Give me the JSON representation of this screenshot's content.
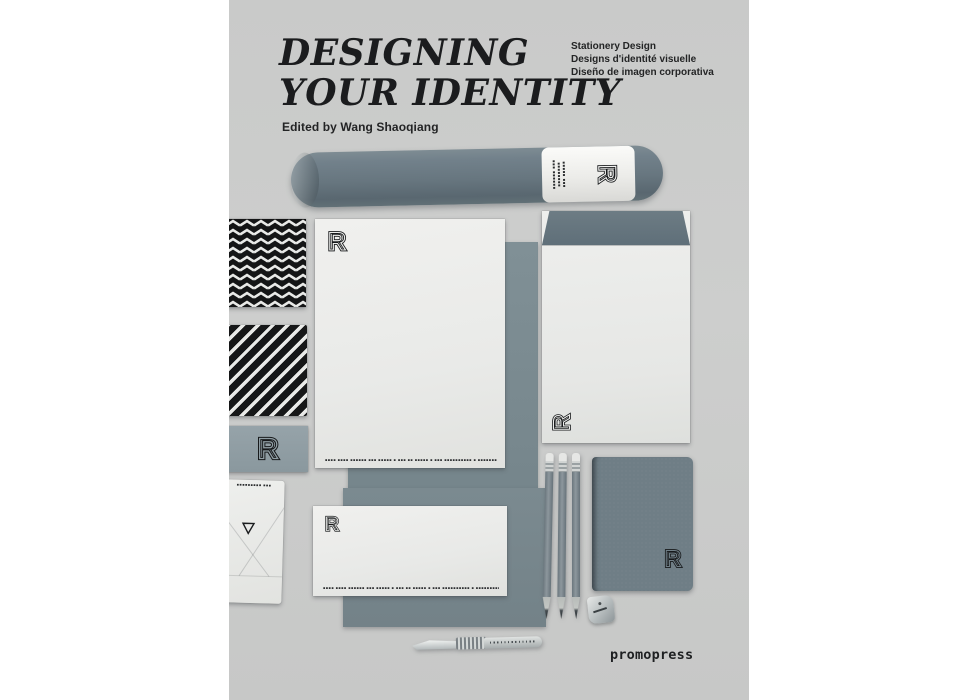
{
  "branding": {
    "title_line1": "DESIGNING",
    "title_line2": "YOUR IDENTITY",
    "editor": "Edited by Wang Shaoqiang",
    "subtitles": [
      "Stationery Design",
      "Designs d'identité visuelle",
      "Diseño de imagen corporativa"
    ],
    "publisher": "promopress"
  },
  "logo": {
    "letter": "R"
  },
  "microtext": {
    "letterhead_footer": "▪▪▪▪ ▪▪▪▪ ▪▪▪▪▪▪ ▪▪▪ ▪▪▪▪▪   ▪ ▪▪▪ ▪▪ ▪▪▪▪▪   ▪ ▪▪▪ ▪▪▪▪▪▪▪▪▪▪   ▪ ▪▪▪▪▪▪▪▪▪▪▪▪",
    "dl_footer": "▪▪▪▪ ▪▪▪▪ ▪▪▪▪▪▪ ▪▪▪ ▪▪▪▪▪   ▪ ▪▪▪ ▪▪ ▪▪▪▪▪   ▪ ▪▪▪ ▪▪▪▪▪▪▪▪▪▪   ▪ ▪▪▪▪▪▪▪▪▪▪▪▪",
    "envelope_card_header": "▪▪▪▪▪▪▪▪▪ ▪▪▪",
    "tube_lines": [
      "▪▪▪▪▪▪ ▪▪▪",
      "▪▪▪▪▪▪▪▪",
      "▪▪▪ ▪▪▪▪▪"
    ]
  },
  "colors": {
    "cover_bg": "#cbcccb",
    "ink_black": "#1b1c1e",
    "steel_blue": "#67767f",
    "sheet_gray": "#7b8a90",
    "card_gray": "#909ea4",
    "paper_white": "#ecedeb"
  }
}
